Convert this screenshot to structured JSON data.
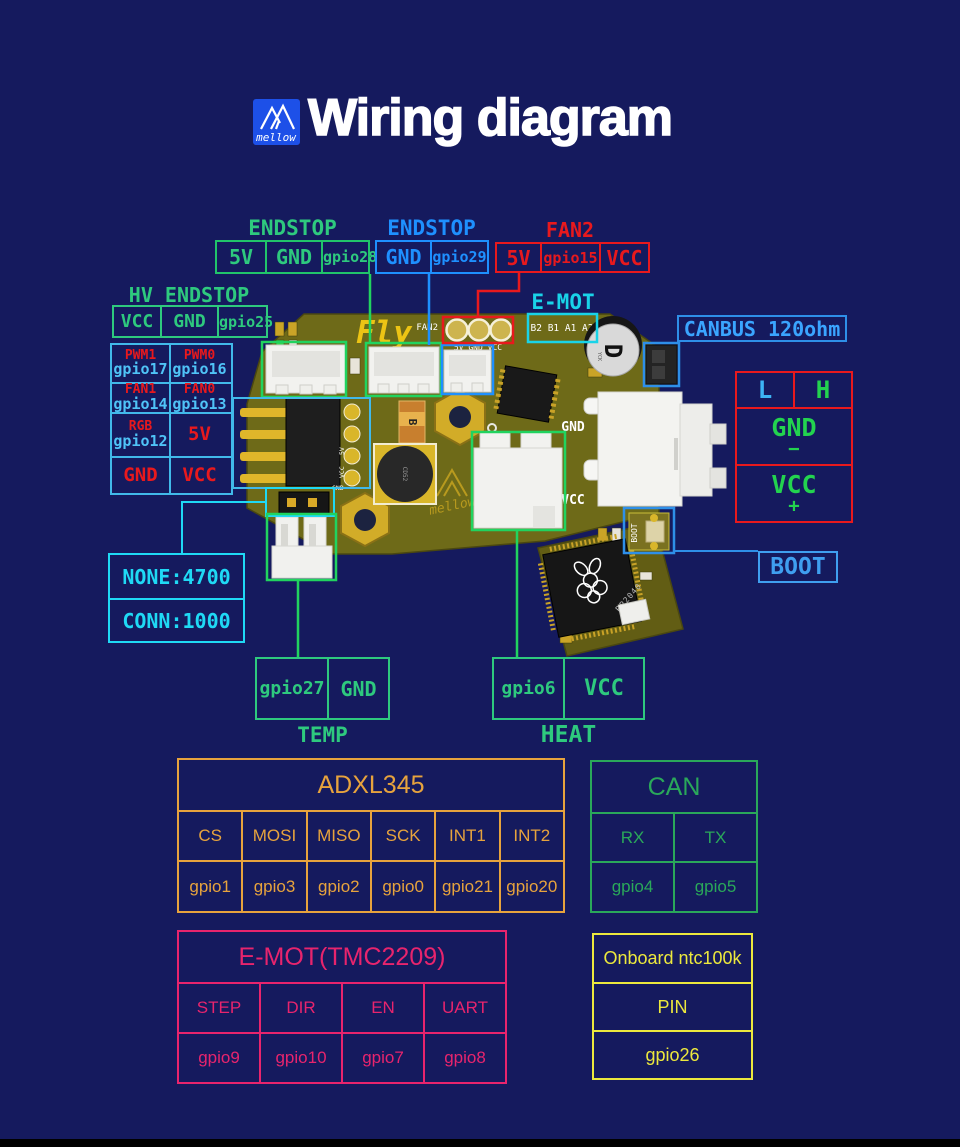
{
  "header": {
    "title": "Wiring diagram",
    "logo_text": "mellow"
  },
  "colors": {
    "background": "#151a5e",
    "green": "#2ec97e",
    "pcb_highlight_green": "#21d35f",
    "blue": "#1e90ff",
    "light_blue": "#41b9ea",
    "cyan": "#1fd9f5",
    "red": "#e8191d",
    "orange": "#e7a33d",
    "pink": "#e8246d",
    "yellow": "#ece83d",
    "board": "#6e6a18"
  },
  "top": {
    "endstop_a": {
      "title": "ENDSTOP",
      "pins": [
        "5V",
        "GND",
        "gpio28"
      ]
    },
    "endstop_b": {
      "title": "ENDSTOP",
      "pins": [
        "GND",
        "gpio29"
      ]
    },
    "fan2": {
      "title": "FAN2",
      "pins": [
        "5V",
        "gpio15",
        "VCC"
      ]
    },
    "hv_endstop": {
      "title": "HV ENDSTOP",
      "pins": [
        "VCC",
        "GND",
        "gpio25"
      ]
    }
  },
  "io_matrix": {
    "rows": [
      {
        "left": {
          "label": "PWM1",
          "pin": "gpio17"
        },
        "right": {
          "label": "PWM0",
          "pin": "gpio16"
        }
      },
      {
        "left": {
          "label": "FAN1",
          "pin": "gpio14"
        },
        "right": {
          "label": "FAN0",
          "pin": "gpio13"
        }
      },
      {
        "left": {
          "label": "RGB",
          "pin": "gpio12"
        },
        "right": {
          "label": "5V"
        }
      },
      {
        "left": {
          "label": "GND"
        },
        "right": {
          "label": "VCC"
        }
      }
    ]
  },
  "emot_probe": {
    "title": "E-MOT"
  },
  "canbus": {
    "label": "CANBUS 120ohm"
  },
  "can_port": {
    "cols": [
      "L",
      "H"
    ],
    "rows": [
      {
        "name": "GND",
        "sign": "−"
      },
      {
        "name": "VCC",
        "sign": "+"
      }
    ]
  },
  "boot": {
    "label": "BOOT"
  },
  "thermistor_jumper": {
    "rows": [
      "NONE:4700",
      "CONN:1000"
    ]
  },
  "temp": {
    "pins": [
      "gpio27",
      "GND"
    ],
    "label": "TEMP"
  },
  "heat": {
    "pins": [
      "gpio6",
      "VCC"
    ],
    "label": "HEAT"
  },
  "tables": {
    "adxl345": {
      "title": "ADXL345",
      "pins": [
        "CS",
        "MOSI",
        "MISO",
        "SCK",
        "INT1",
        "INT2"
      ],
      "gpios": [
        "gpio1",
        "gpio3",
        "gpio2",
        "gpio0",
        "gpio21",
        "gpio20"
      ]
    },
    "can": {
      "title": "CAN",
      "pins": [
        "RX",
        "TX"
      ],
      "gpios": [
        "gpio4",
        "gpio5"
      ]
    },
    "emot": {
      "title": "E-MOT(TMC2209)",
      "pins": [
        "STEP",
        "DIR",
        "EN",
        "UART"
      ],
      "gpios": [
        "gpio9",
        "gpio10",
        "gpio7",
        "gpio8"
      ]
    },
    "ntc": {
      "rows": [
        "Onboard ntc100k",
        "PIN",
        "gpio26"
      ]
    }
  },
  "pcb": {
    "brand": "Fly",
    "fan2_silk": "FAN2",
    "fan2_pins": "5V GND VCC",
    "emot_silk": "B2 B1 A1 A2",
    "hv_silk": "HV-IN",
    "gnd_silk": "GND",
    "vcc_silk": "VCC",
    "chip": "RP2040",
    "boot_silk": "BOOT",
    "mellow": "mellow",
    "inductor": "CD52",
    "cap_code": "B",
    "cap_mark": "D"
  }
}
